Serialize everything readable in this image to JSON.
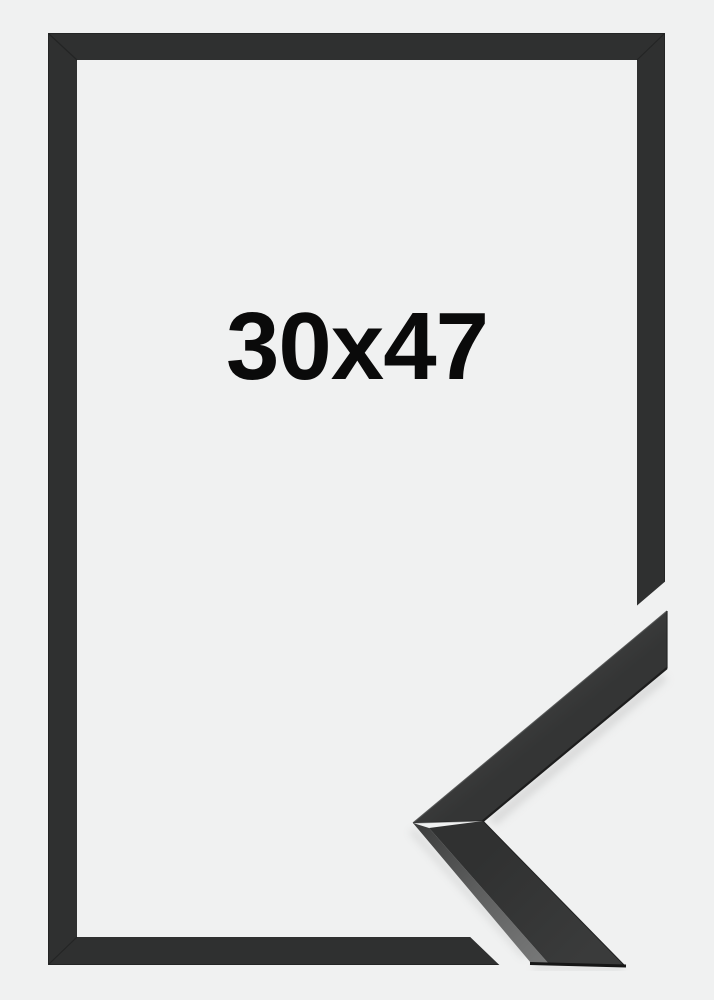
{
  "product_image": {
    "size_label": "30x47",
    "colors": {
      "background": "#f0f1f1",
      "frame": "#2f3030",
      "label_text": "#0a0a0a",
      "moulding_top_face": "#383939",
      "moulding_side_face": "#333434",
      "moulding_lit_edge": "#6f7070"
    }
  }
}
